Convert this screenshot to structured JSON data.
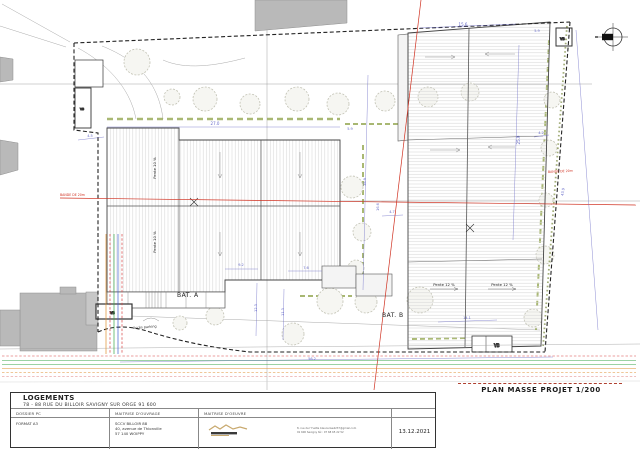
{
  "plan": {
    "caption": "PLAN MASSE PROJET 1/200",
    "buildings": {
      "bat_a": "BAT. A",
      "bat_b": "BAT. B",
      "pente_a": "Pente 10 %",
      "pente_b": "Pente 12 %"
    },
    "annotations": {
      "band_left": "BANDE DE 20m",
      "band_right": "BANDE DE 20m",
      "acces_parking": "Accès parking",
      "vb": "VB"
    },
    "dims": [
      "27.0",
      "5.9",
      "15.6",
      "5.9",
      "4.5",
      "25.9",
      "4.2",
      "38.9",
      "16.6",
      "4.7",
      "43.9",
      "9.2",
      "7.6",
      "14.1",
      "12.3",
      "11.3",
      "56.2"
    ],
    "colors": {
      "dimension": "#6468c8",
      "band": "#d03020",
      "hedge": "#9aab5a",
      "boundary": "#222222",
      "utility_green": "#3aa648",
      "utility_orange": "#e09030",
      "utility_red": "#d84040"
    }
  },
  "title_block": {
    "project": "LOGEMENTS",
    "address": "78 - 88 RUE DU BILLOIR SAVIGNY SUR ORGE 91 600",
    "headers": {
      "col1": "DOSSIER PC",
      "col2": "MAITRISE D'OUVRAGE",
      "col3": "MAITRISE D'OEUVRE"
    },
    "format": "FORMAT A3",
    "owner": {
      "name": "SCCV BILLOIR 88",
      "line1": "40, avenue de Thionville",
      "line2": "57 140 WOIPPY"
    },
    "contact": {
      "line1": "8, rue de l'Yvette    bleucerise4237@gmail.com",
      "line2": "91 600 Savigny    tél : 07 68 65 22 52"
    },
    "date": "13.12.2021"
  }
}
